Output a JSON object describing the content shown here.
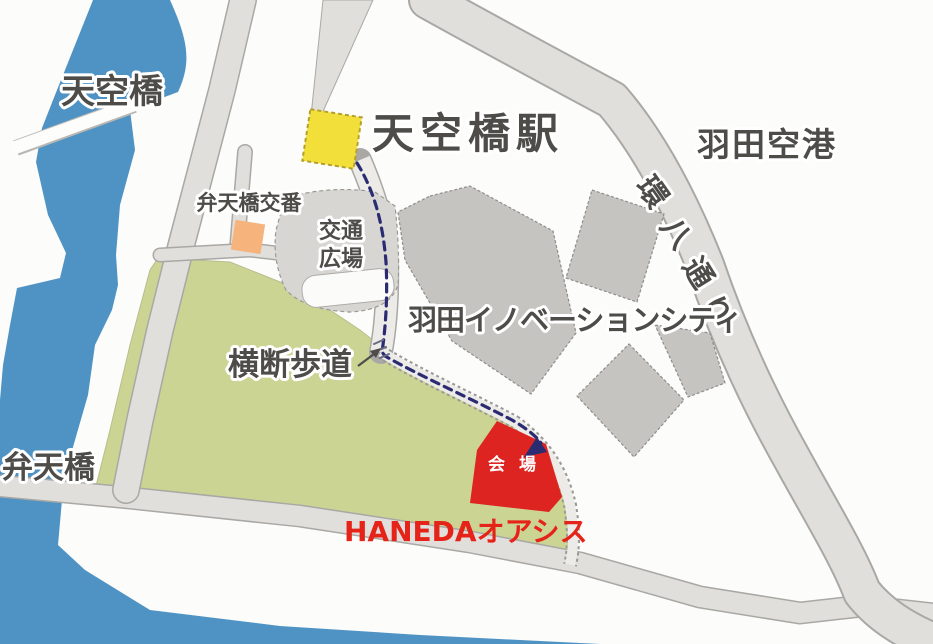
{
  "map": {
    "title": "羽田エリア 会場案内図",
    "labels": {
      "river_bridge_top": "天空橋",
      "station": "天空橋駅",
      "airport": "羽田空港",
      "kanpachi": [
        "環",
        "八",
        "通",
        "り"
      ],
      "police_box": "弁天橋交番",
      "plaza_line1": "交通",
      "plaza_line2": "広場",
      "innovation_city": "羽田イノベーションシティ",
      "crosswalk": "横断歩道",
      "bridge_bottom": "弁天橋",
      "venue": "会 場",
      "oasis": "HANEDAオアシス"
    },
    "colors": {
      "background": "#fcfcfa",
      "water": "#4f93c4",
      "park": "#ccd494",
      "road": "#e0dfdc",
      "road_border": "#a9a8a4",
      "building": "#c6c4c1",
      "station_yellow": "#f2df3a",
      "police_orange": "#f6b37b",
      "venue_red": "#dd2420",
      "route_navy": "#2b2b72",
      "label_gray": "#4d4c49",
      "oasis_red": "#e62319"
    }
  }
}
